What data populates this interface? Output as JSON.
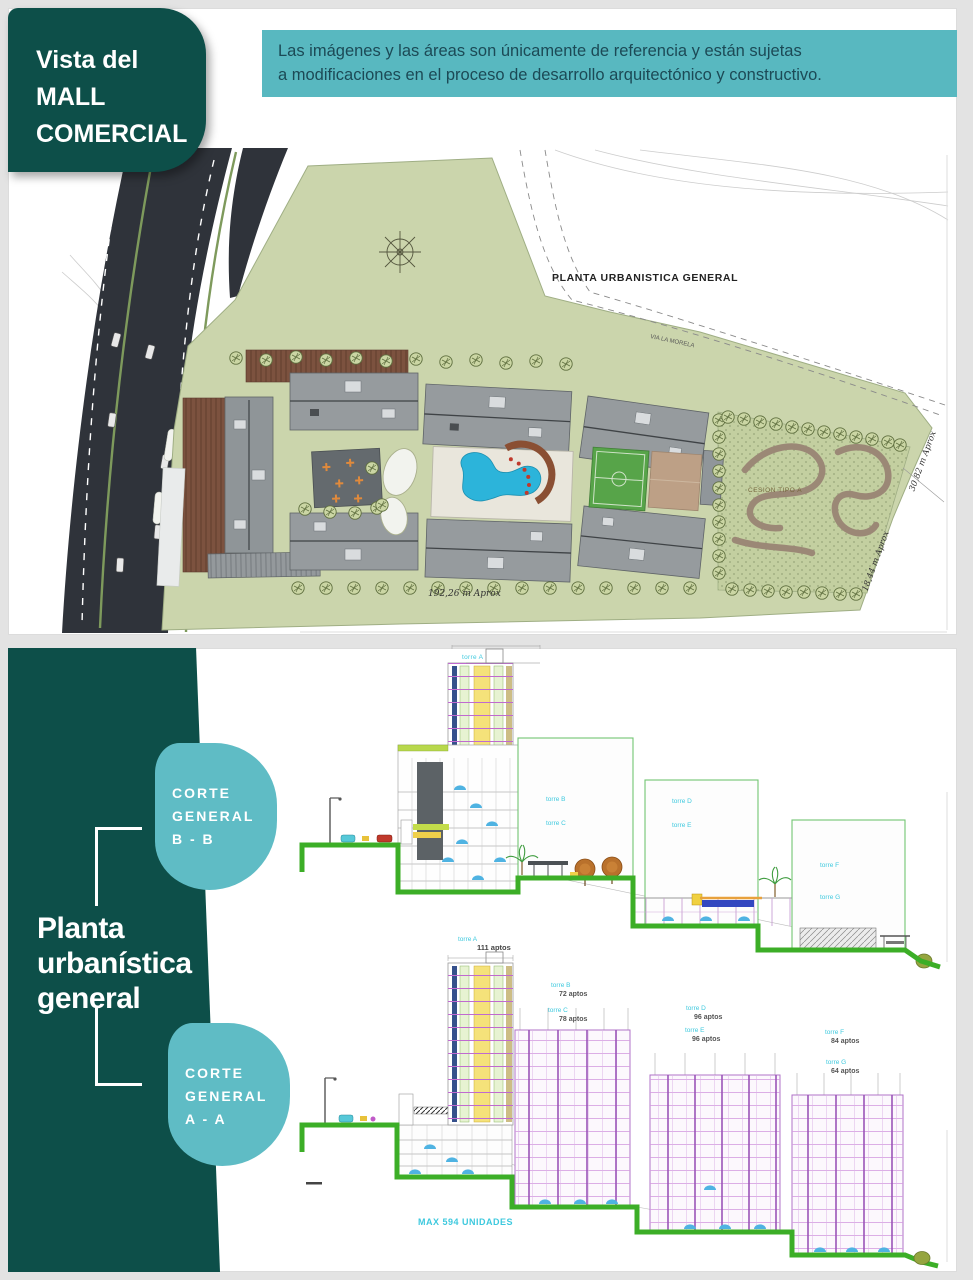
{
  "slide": {
    "colors": {
      "dark_teal": "#0d4f49",
      "banner_teal": "#58b8c0",
      "leaf_teal": "#5fbcc5",
      "site_green": "#cbd5ac",
      "terrain_green": "#3cae27",
      "pool_blue": "#2cb4da",
      "grid_magenta": "#c06ad0",
      "label_cyan": "#3ec9de"
    },
    "top": {
      "box": {
        "l1": "Vista del",
        "l2": "MALL",
        "l3": "COMERCIAL"
      },
      "disclaimer": {
        "l1": "Las imágenes y las áreas son únicamente de referencia y están sujetas",
        "l2": "a modificaciones en el proceso de desarrollo arquitectónico y constructivo."
      },
      "plan": {
        "title": "PLANTA URBANISTICA GENERAL",
        "via": "VIA LA MORELA",
        "cesion": "CESION TIPO A",
        "dim_w": "192,26 m Aprox",
        "dim_r1": "30,82 m Aprox",
        "dim_r2": "18,44 m Aprox"
      }
    },
    "bottom": {
      "title": {
        "l1": "Planta",
        "l2": "urbanística",
        "l3": "general"
      },
      "bb_tag": {
        "l1": "CORTE",
        "l2": "GENERAL",
        "l3": "B - B"
      },
      "aa_tag": {
        "l1": "CORTE",
        "l2": "GENERAL",
        "l3": "A - A"
      },
      "bb": {
        "tower": "torre A",
        "b1a": "torre B",
        "b1b": "torre C",
        "b2a": "torre D",
        "b2b": "torre E",
        "b3a": "torre F",
        "b3b": "torre G"
      },
      "aa": {
        "tower": "torre A",
        "tower_units": "111 aptos",
        "towers": [
          {
            "n": "torre B",
            "u": "72 aptos"
          },
          {
            "n": "torre C",
            "u": "78 aptos"
          },
          {
            "n": "torre D",
            "u": "96 aptos"
          },
          {
            "n": "torre E",
            "u": "96 aptos"
          },
          {
            "n": "torre F",
            "u": "84 aptos"
          },
          {
            "n": "torre G",
            "u": "64 aptos"
          }
        ],
        "total": "MAX 594 UNIDADES"
      }
    }
  }
}
